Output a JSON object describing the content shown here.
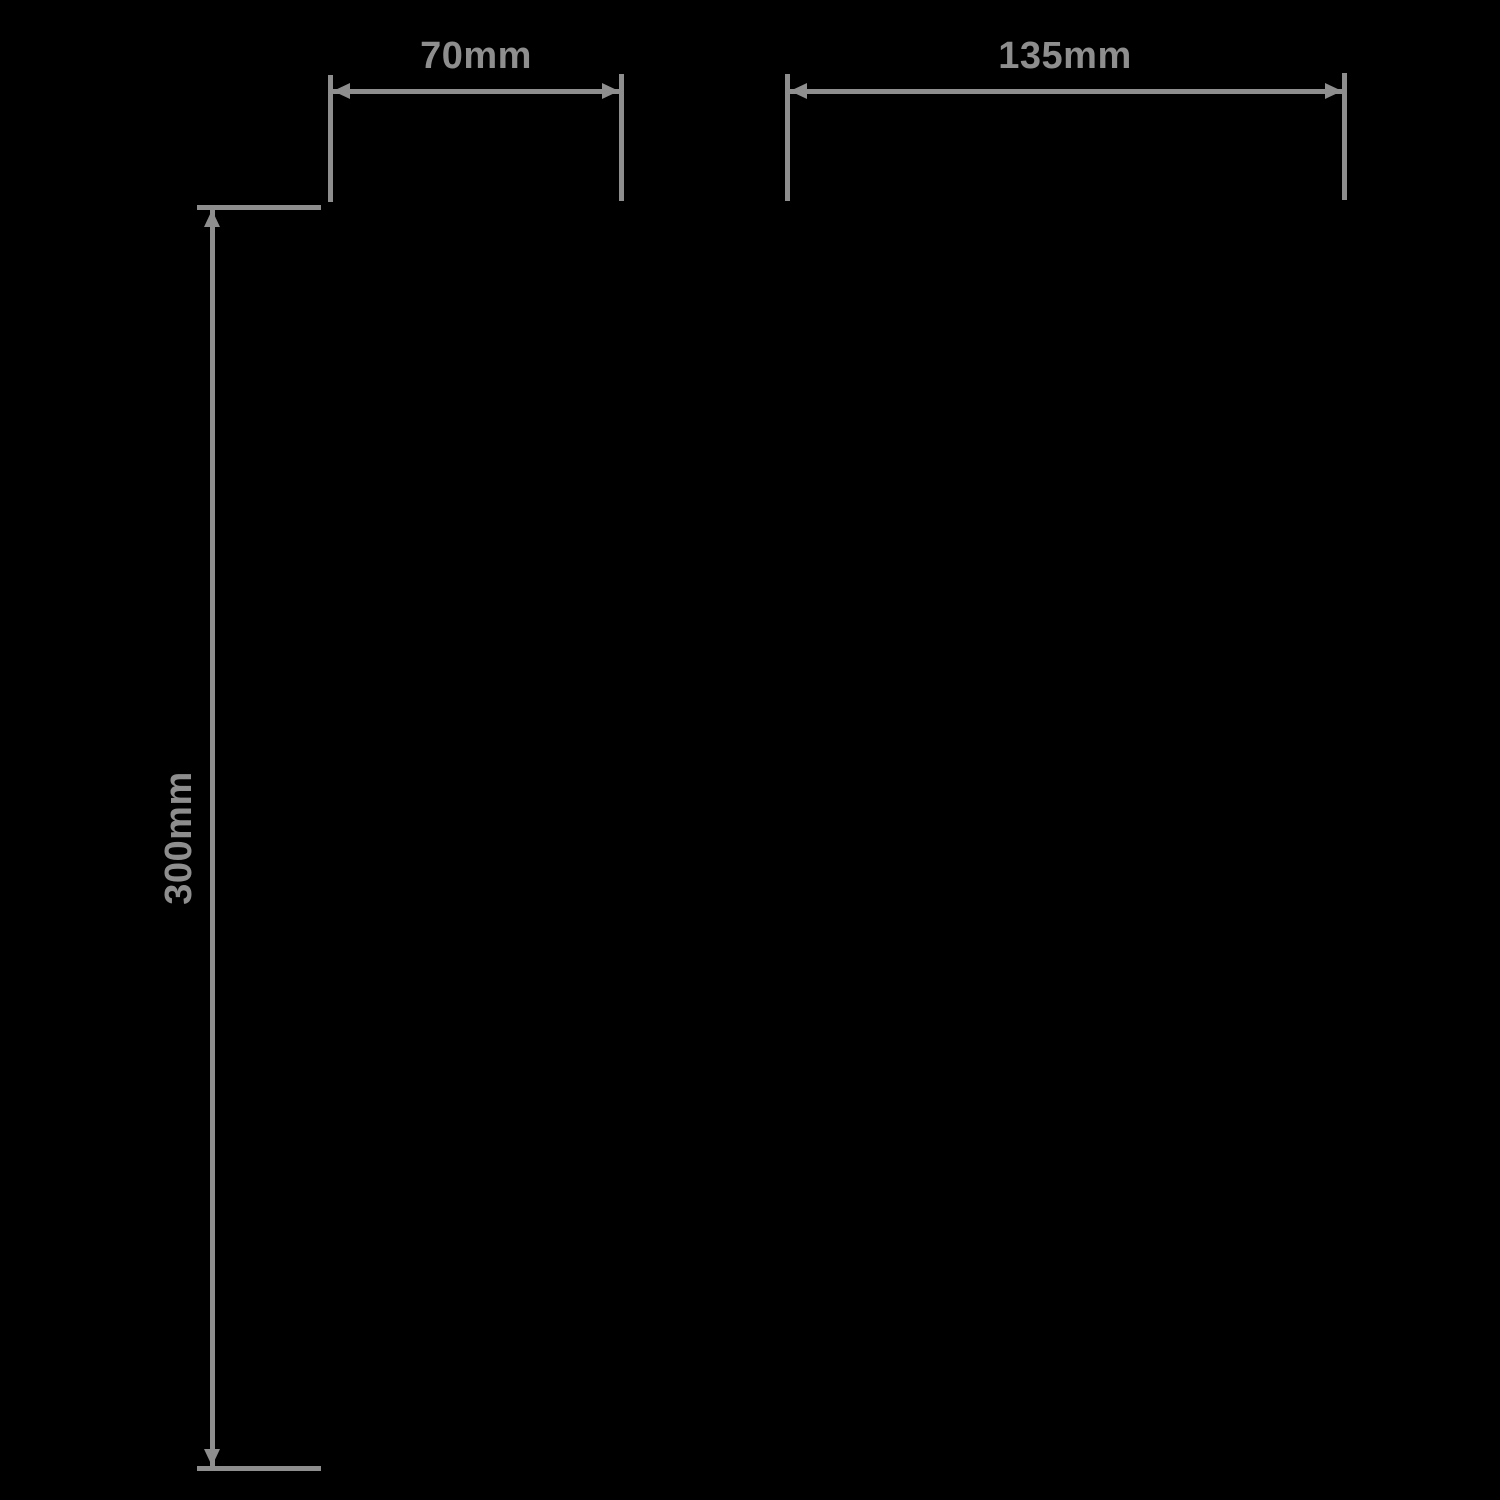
{
  "page": {
    "background_color": "#000000",
    "annotation_color": "#8e8e8e"
  },
  "dimensions": [
    {
      "id": "top-left-width",
      "label": "70mm",
      "orientation": "horizontal"
    },
    {
      "id": "top-right-width",
      "label": "135mm",
      "orientation": "horizontal"
    },
    {
      "id": "left-height",
      "label": "300mm",
      "orientation": "vertical"
    }
  ]
}
